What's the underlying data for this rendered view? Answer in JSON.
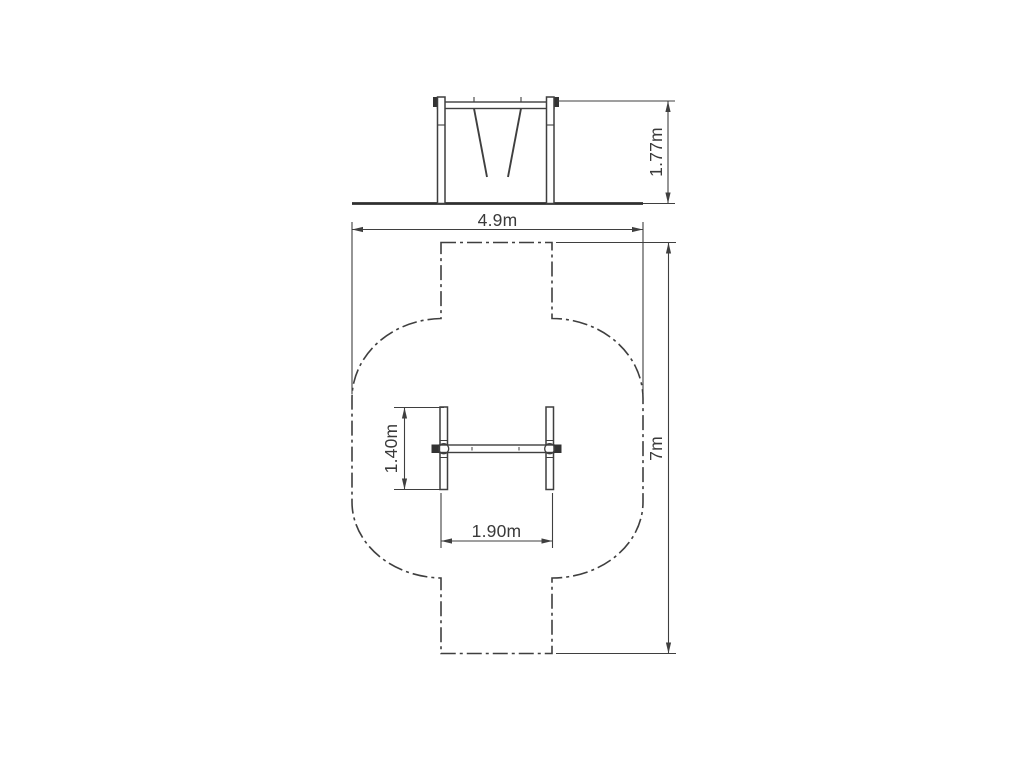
{
  "drawing": {
    "background_color": "#ffffff",
    "line_color": "#3f3f3f",
    "ground_color": "#2f2f2f",
    "solid_fill": "#333333",
    "text_color": "#3a3a3a",
    "dimensions": {
      "frame_height": "1.77m",
      "zone_width": "4.9m",
      "zone_length": "7m",
      "frame_depth": "1.40m",
      "frame_span": "1.90m"
    }
  }
}
